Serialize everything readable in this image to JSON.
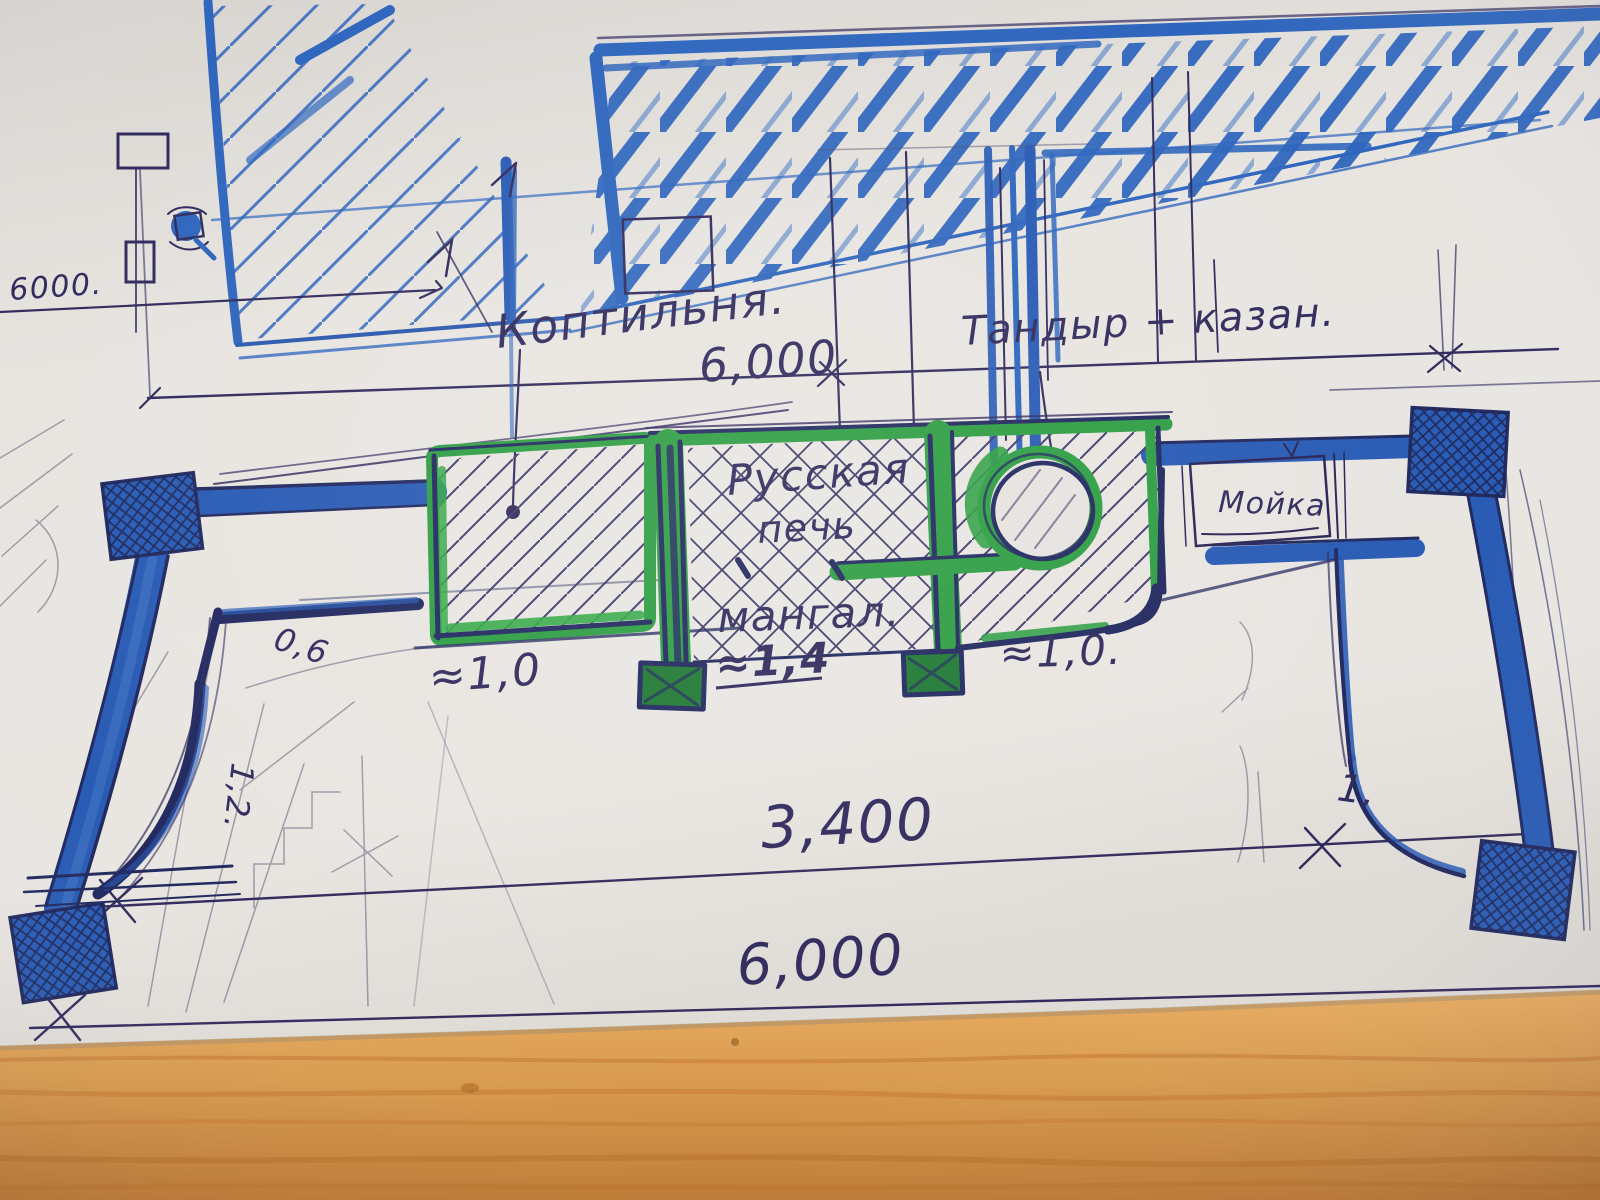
{
  "labels": {
    "smokehouse": "Коптильня.",
    "tandoor_kazan": "Тандыр + казан.",
    "russian_stove_1": "Русская",
    "russian_stove_2": "печь",
    "mangal": "мангал.",
    "sink": "Мойка"
  },
  "dimensions": {
    "far_left_width": "6000.",
    "top_width": "6,000",
    "inner_width": "3,400",
    "bottom_width": "6,000",
    "smokehouse_width": "≈1,0",
    "mangal_width": "≈1,4",
    "tandoor_width": "≈1,0.",
    "left_wall_offset": "0,6",
    "left_wall_depth": "1,2.",
    "right_wall_depth": "1,"
  },
  "colors": {
    "marker_blue": "#2a5cb5",
    "pen_navy": "#322c5e",
    "marker_green": "#2f9e44",
    "paper": "#e7e4e0",
    "wood_table": "#d89a4f"
  }
}
